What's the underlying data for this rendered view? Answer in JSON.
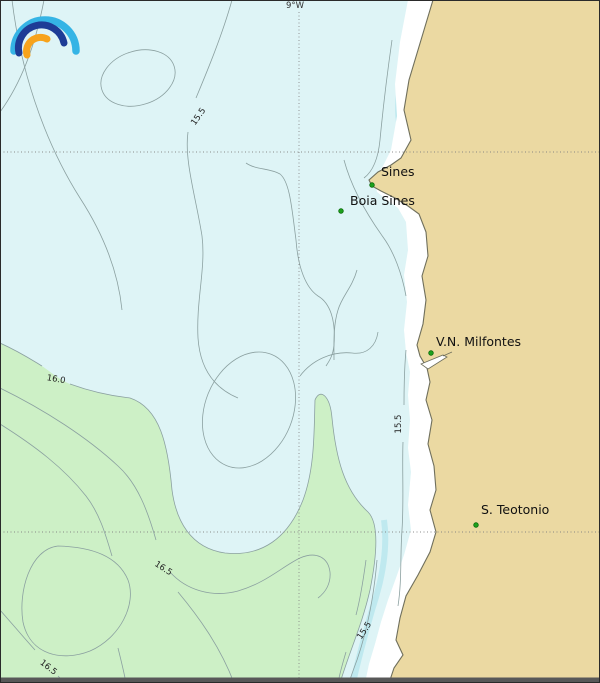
{
  "axis": {
    "top_label": "9°W"
  },
  "logo": {
    "name": "ipma-rainbow-logo",
    "arc_colors": {
      "outer": "#35b4e5",
      "middle": "#1e3c96",
      "inner": "#f7a31c"
    }
  },
  "colors": {
    "sea": "#def4f6",
    "green_band": "#cdf0c6",
    "land": "#ebd9a2",
    "coast_strip": "#ffffff",
    "shallow_band": "#bfe9ef",
    "contour": "#8ba0a0",
    "coastline": "#6f6f5c",
    "grid": "#808080",
    "marker": "#1da11d",
    "marker_edge": "#0a6b0a",
    "bottom_bar": "#585858"
  },
  "places": [
    {
      "label": "Sines"
    },
    {
      "label": "Boia Sines"
    },
    {
      "label": "V.N. Milfontes"
    },
    {
      "label": "S. Teotonio"
    }
  ],
  "contour_labels": [
    {
      "value": "15.5"
    },
    {
      "value": "16.0"
    },
    {
      "value": "16.5"
    },
    {
      "value": "16.5"
    },
    {
      "value": "15.5"
    },
    {
      "value": "15.5"
    }
  ],
  "map_data": {
    "type": "contour-map",
    "contour_values": [
      15.5,
      16.0,
      16.5
    ],
    "grid": {
      "vertical_line_label": "9°W",
      "horizontal_lines": 2
    }
  }
}
